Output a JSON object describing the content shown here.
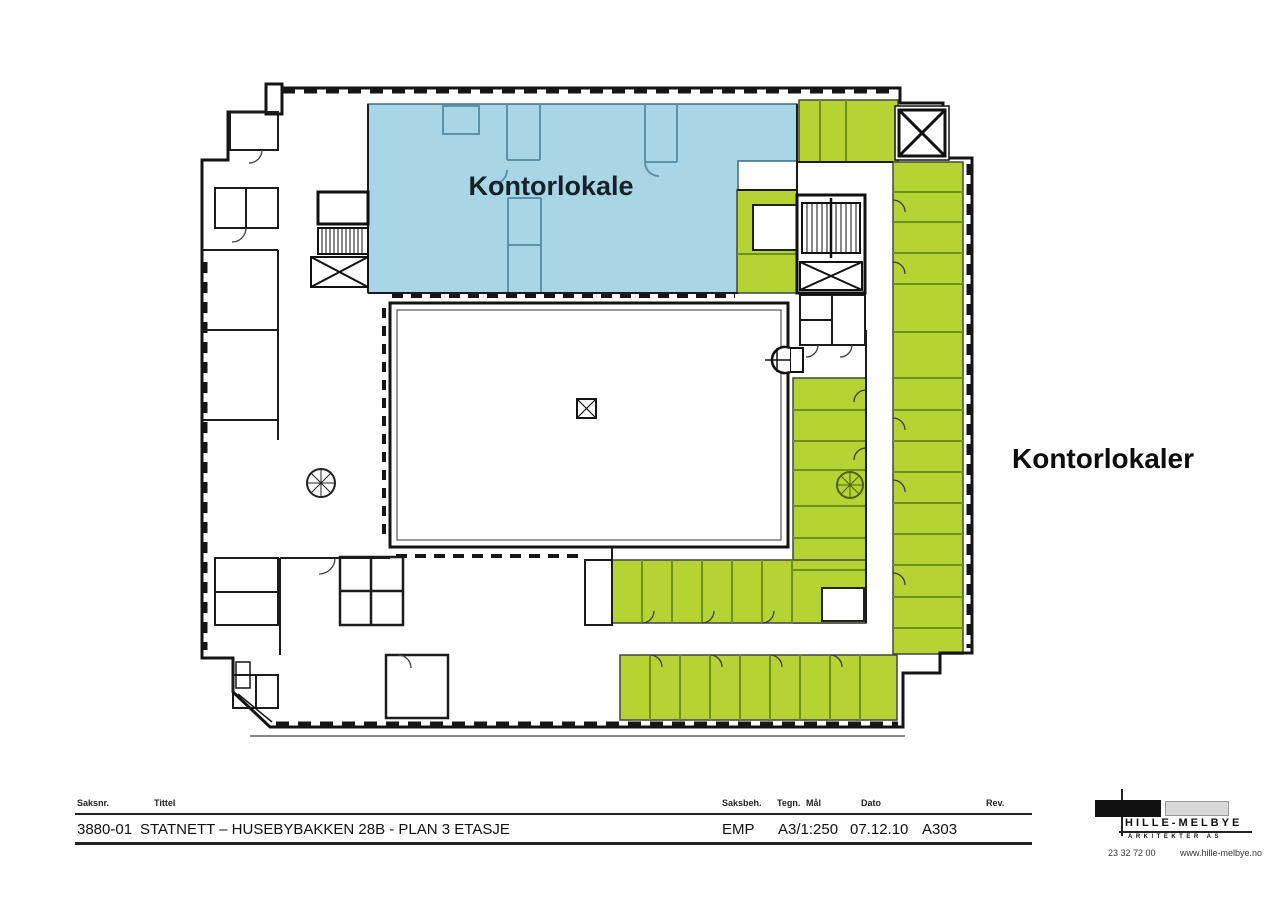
{
  "colors": {
    "zone_blue": "#a9d6e5",
    "zone_green": "#b5d433",
    "wall": "#161616"
  },
  "plan": {
    "label_blue_zone": "Kontorlokale",
    "label_green_zone": "Kontorlokaler"
  },
  "title_block": {
    "labels": {
      "saksnr": "Saksnr.",
      "tittel": "Tittel",
      "saksbeh": "Saksbeh.",
      "tegn": "Tegn.",
      "maal": "Mål",
      "dato": "Dato",
      "rev": "Rev."
    },
    "values": {
      "saksnr": "3880-01",
      "tittel": "STATNETT – HUSEBYBAKKEN 28B - PLAN 3 ETASJE",
      "saksbeh": "EMP",
      "maal": "A3/1:250",
      "dato": "07.12.10",
      "tegning_nr": "A303"
    }
  },
  "logo": {
    "name": "HILLE-MELBYE",
    "subtitle": "ARKITEKTER AS",
    "phone": "23 32 72 00",
    "web": "www.hille-melbye.no"
  }
}
